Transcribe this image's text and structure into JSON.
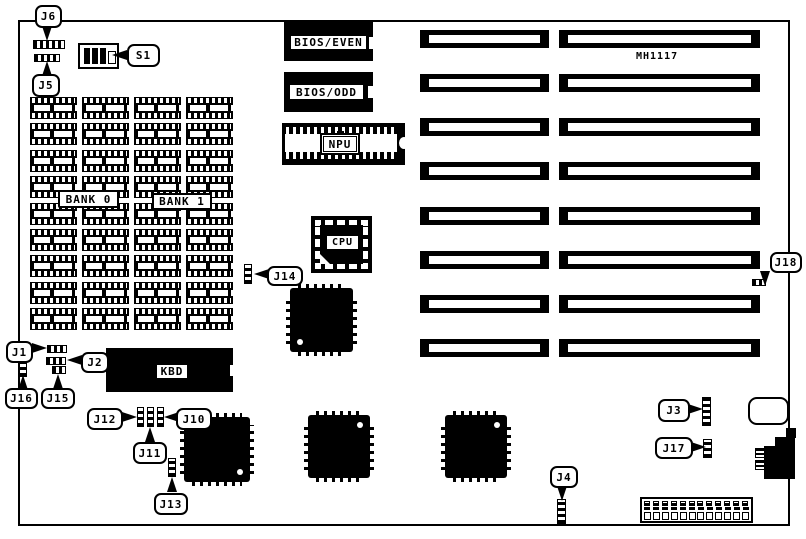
{
  "board": {
    "model_number": "MH1117"
  },
  "chips": {
    "bios_even": "BIOS/EVEN",
    "bios_odd": "BIOS/ODD",
    "npu": "NPU",
    "cpu": "CPU",
    "kbd": "KBD"
  },
  "memory": {
    "bank0_label": "BANK 0",
    "bank1_label": "BANK 1",
    "columns": 4,
    "rows": 9
  },
  "jumper_labels": {
    "j1": "J1",
    "j2": "J2",
    "j3": "J3",
    "j4": "J4",
    "j5": "J5",
    "j6": "J6",
    "j10": "J10",
    "j11": "J11",
    "j12": "J12",
    "j13": "J13",
    "j14": "J14",
    "j15": "J15",
    "j16": "J16",
    "j17": "J17",
    "j18": "J18"
  },
  "switch_labels": {
    "s1": "S1"
  },
  "expansion_slots": {
    "count": 8
  },
  "bottom_connector": {
    "positions": 12
  },
  "colors": {
    "foreground": "#000000",
    "background": "#ffffff"
  }
}
